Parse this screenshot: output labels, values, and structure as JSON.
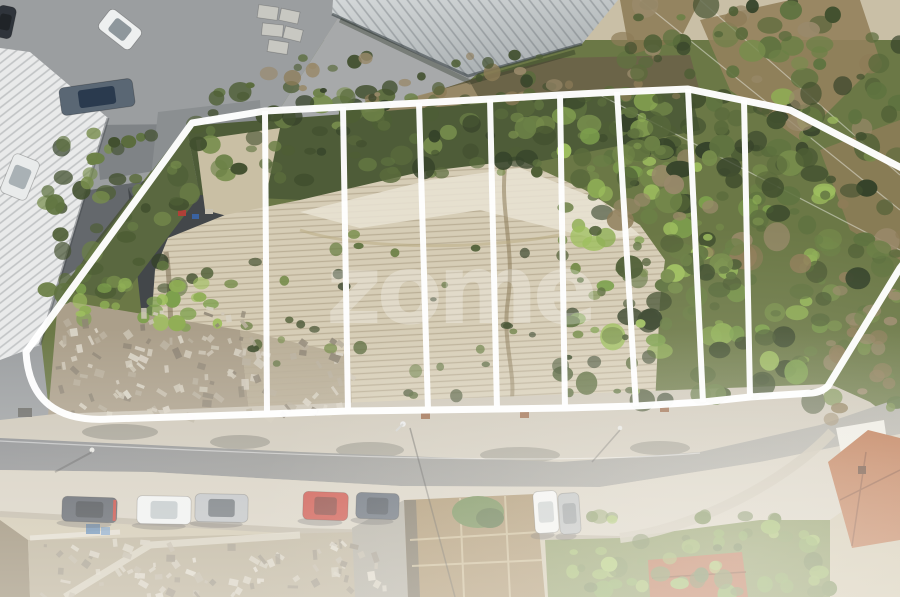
{
  "watermark": {
    "text": "zome",
    "color": "rgba(255,255,255,0.27)"
  },
  "annotation": {
    "color": "#ffffff",
    "parcel_count": 9,
    "boundary_path": "M192,123 L265,111 L343,107 L419,103 L490,99 L560,95 L617,92 L688,89 L790,110 L940,188 L940,216 L900,268 L828,386 Q822,392 812,393 L750,397 L703,402 L636,406 L565,408 L497,409 L428,410 L348,411 L267,414 L110,419 Q30,424 26,352 Z",
    "dividers": [
      {
        "x1": 265,
        "y1": 111,
        "x2": 267,
        "y2": 414
      },
      {
        "x1": 343,
        "y1": 107,
        "x2": 348,
        "y2": 411
      },
      {
        "x1": 419,
        "y1": 103,
        "x2": 428,
        "y2": 410
      },
      {
        "x1": 490,
        "y1": 99,
        "x2": 497,
        "y2": 409
      },
      {
        "x1": 560,
        "y1": 95,
        "x2": 565,
        "y2": 408
      },
      {
        "x1": 617,
        "y1": 92,
        "x2": 636,
        "y2": 406
      },
      {
        "x1": 688,
        "y1": 89,
        "x2": 703,
        "y2": 402
      },
      {
        "x1": 744,
        "y1": 100,
        "x2": 750,
        "y2": 397
      }
    ]
  },
  "vehicles": [
    {
      "name": "white-van",
      "x": 100,
      "y": 17,
      "w": 40,
      "h": 25,
      "angle": 38,
      "body": "#eef0f0",
      "glass": "#8e979c",
      "shadow": false
    },
    {
      "name": "box-truck",
      "x": 60,
      "y": 83,
      "w": 74,
      "h": 28,
      "angle": -8,
      "body": "#5a6774",
      "glass": "#2a3a4e",
      "shadow": false
    },
    {
      "name": "white-car-yard",
      "x": 6,
      "y": 156,
      "w": 28,
      "h": 42,
      "angle": 22,
      "body": "#e9ebeb",
      "glass": "#a9b1b5",
      "shadow": false
    },
    {
      "name": "dark-car-top-left",
      "x": -4,
      "y": 6,
      "w": 18,
      "h": 32,
      "angle": 12,
      "body": "#2f343b",
      "glass": "#202428",
      "shadow": false
    },
    {
      "name": "dark-grey-suv",
      "x": 62,
      "y": 497,
      "w": 55,
      "h": 25,
      "angle": 2,
      "body": "#474d57",
      "glass": "#2c3138",
      "accent": "#c03028",
      "shadow": true
    },
    {
      "name": "white-car",
      "x": 137,
      "y": 496,
      "w": 54,
      "h": 28,
      "angle": 1,
      "body": "#edeff0",
      "glass": "#b9c1c5",
      "shadow": true
    },
    {
      "name": "silver-minivan",
      "x": 195,
      "y": 494,
      "w": 53,
      "h": 28,
      "angle": 1,
      "body": "#b7bbbf",
      "glass": "#5f666d",
      "shadow": true
    },
    {
      "name": "red-car",
      "x": 303,
      "y": 492,
      "w": 45,
      "h": 28,
      "angle": 2,
      "body": "#c43a30",
      "glass": "#7e2a24",
      "shadow": true
    },
    {
      "name": "dark-blue-car",
      "x": 356,
      "y": 493,
      "w": 43,
      "h": 26,
      "angle": 2,
      "body": "#4e5866",
      "glass": "#333b46",
      "shadow": true
    },
    {
      "name": "white-car-perpendicular",
      "x": 534,
      "y": 491,
      "w": 24,
      "h": 42,
      "angle": -4,
      "body": "#f0f2f2",
      "glass": "#c2c8ca",
      "shadow": true
    },
    {
      "name": "silver-car-perpendicular",
      "x": 559,
      "y": 493,
      "w": 21,
      "h": 41,
      "angle": -4,
      "body": "#b2b6b8",
      "glass": "#888e92",
      "shadow": true
    }
  ]
}
